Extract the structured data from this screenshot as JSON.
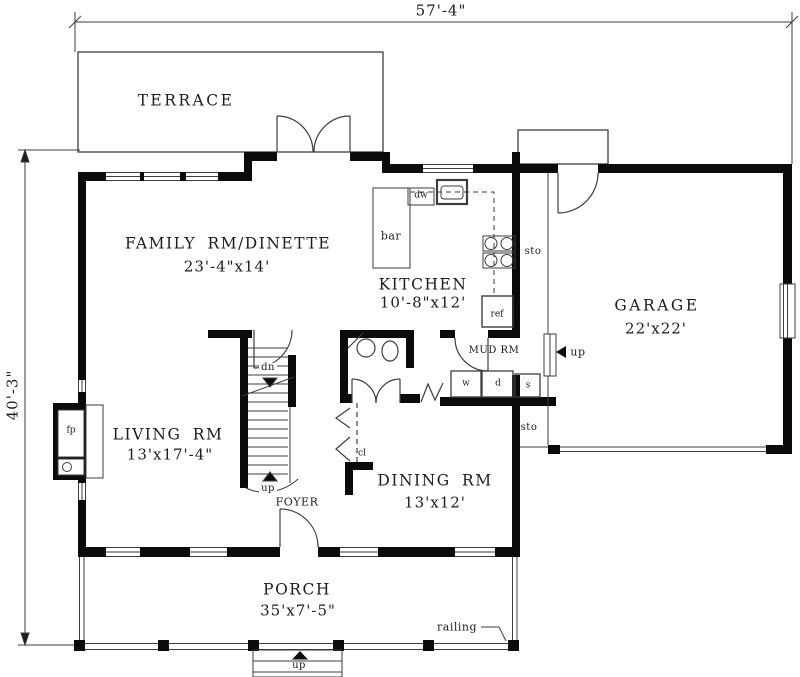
{
  "drawing": {
    "type": "first-floor-plan"
  },
  "dimensions": {
    "overall_width": "57'-4\"",
    "overall_depth": "40'-3\""
  },
  "rooms": {
    "terrace": {
      "label": "TERRACE"
    },
    "family_dinette": {
      "label": "FAMILY RM/DINETTE",
      "size": "23'-4\"x14'"
    },
    "kitchen": {
      "label": "KITCHEN",
      "size": "10'-8\"x12'"
    },
    "garage": {
      "label": "GARAGE",
      "size": "22'x22'"
    },
    "living": {
      "label": "LIVING RM",
      "size": "13'x17'-4\""
    },
    "dining": {
      "label": "DINING RM",
      "size": "13'x12'"
    },
    "foyer": {
      "label": "FOYER"
    },
    "mud_room": {
      "label": "MUD RM"
    },
    "porch": {
      "label": "PORCH",
      "size": "35'x7'-5\""
    }
  },
  "annotations": {
    "stairs_down": "dn",
    "stairs_up": "up",
    "garage_steps_up": "up",
    "porch_steps_up": "up",
    "dishwasher": "dw",
    "bar": "bar",
    "refrigerator": "ref",
    "storage_upper": "sto",
    "storage_lower": "sto",
    "washer": "w",
    "dryer": "d",
    "laundry_sink": "s",
    "closet": "cl",
    "fireplace": "fp",
    "railing": "railing"
  },
  "colors": {
    "wall": "#0b0b0b",
    "line": "#3d3d3d",
    "background": "#ffffff",
    "text": "#1c1c1c"
  }
}
